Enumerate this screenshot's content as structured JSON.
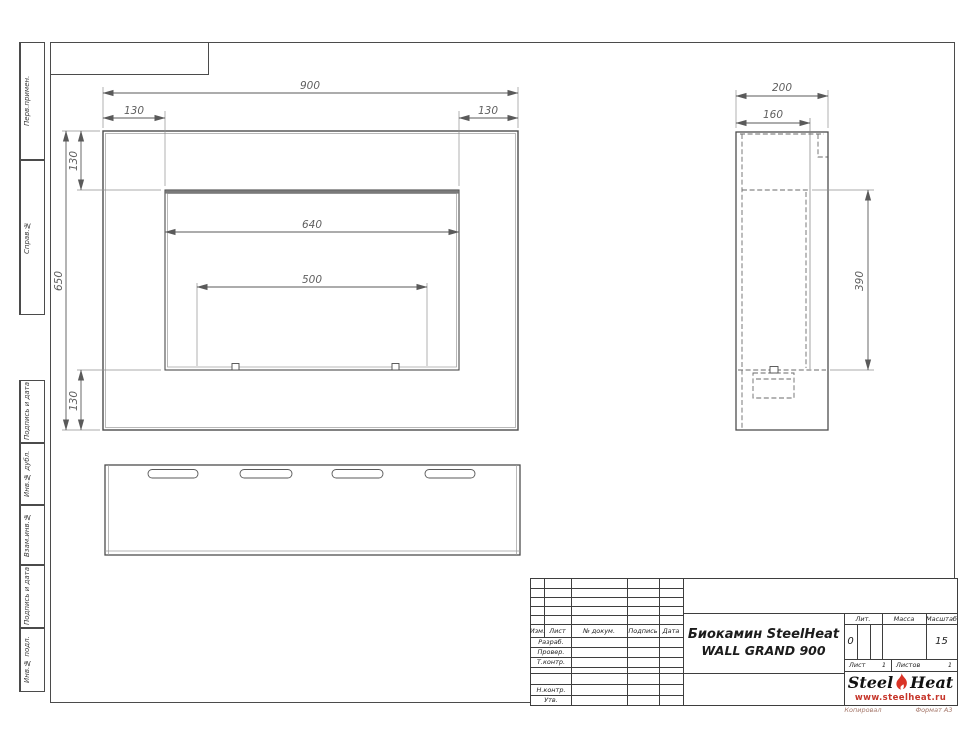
{
  "drawing": {
    "dims": {
      "front_width": "900",
      "front_inset_left": "130",
      "front_inset_right": "130",
      "front_inset_top": "130",
      "front_height": "650",
      "front_inset_bottom": "130",
      "opening_width": "640",
      "burner_width": "500",
      "side_depth": "200",
      "side_inner_depth": "160",
      "side_opening_height": "390"
    }
  },
  "sidebar": {
    "items": [
      {
        "label": "Перв.примен."
      },
      {
        "label": "Справ.№"
      },
      {
        "label": "Подпись и дата"
      },
      {
        "label": "Инв.№ дубл."
      },
      {
        "label": "Взам.инв.№"
      },
      {
        "label": "Подпись и дата"
      },
      {
        "label": "Инв.№ подл."
      }
    ]
  },
  "title_block": {
    "change_header": [
      "Изм.",
      "Лист",
      "№ докум.",
      "Подпись",
      "Дата"
    ],
    "sign_rows": [
      "Разраб.",
      "Провер.",
      "Т.контр.",
      "Н.контр.",
      "Утв."
    ],
    "title_line1": "Биокамин SteelHeat",
    "title_line2": "WALL GRAND 900",
    "lit_label": "Лит.",
    "lit_value": "0",
    "mass_label": "Масса",
    "scale_label": "Масштаб",
    "scale_value": "15",
    "sheet_label": "Лист",
    "sheet_number": "1",
    "sheets_label": "Листов",
    "sheets_total": "1"
  },
  "logo": {
    "name_part1": "Steel",
    "name_part2": "Heat",
    "website": "www.steelheat.ru"
  },
  "footer": {
    "copied_label": "Копировал",
    "format_label": "Формат А3"
  },
  "colors": {
    "outline": "#4d4d4d",
    "thin_line": "#8f8f8f",
    "dim_text": "#5f5f5f",
    "accent_red": "#d93528"
  }
}
